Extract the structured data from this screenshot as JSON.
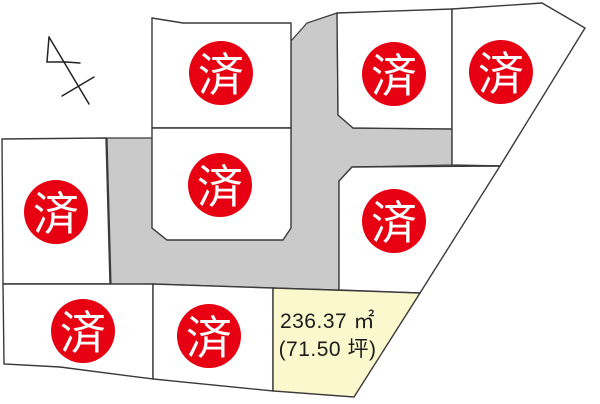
{
  "canvas": {
    "width": 600,
    "height": 404,
    "background": "#ffffff"
  },
  "palette": {
    "lot_fill": "#ffffff",
    "available_fill": "#fbf8cd",
    "road_fill": "#cacaca",
    "boundary": "#3a3a3a",
    "stamp_red": "#e60012",
    "stamp_text_color": "#ffffff",
    "label_text_color": "#1c1c1c"
  },
  "sold_stamp": {
    "label": "済",
    "radius": 32
  },
  "available_lot": {
    "area_m2": "236.37 ㎡",
    "area_tsubo": "(71.50 坪)"
  },
  "map": {
    "roads": [
      {
        "name": "access-road",
        "points": [
          [
            107,
            138
          ],
          [
            291,
            138
          ],
          [
            291,
            41
          ],
          [
            307,
            23
          ],
          [
            337,
            13
          ],
          [
            338,
            115
          ],
          [
            353,
            128
          ],
          [
            452,
            129
          ],
          [
            452,
            165
          ],
          [
            352,
            167
          ],
          [
            339,
            181
          ],
          [
            339,
            290
          ],
          [
            273,
            288
          ],
          [
            153,
            284
          ],
          [
            111,
            285
          ]
        ]
      }
    ],
    "lots": [
      {
        "name": "lot-top-center",
        "status": "sold",
        "points": [
          [
            152,
            18
          ],
          [
            183,
            23
          ],
          [
            291,
            23
          ],
          [
            291,
            128
          ],
          [
            152,
            128
          ]
        ],
        "stamp": [
          221,
          73
        ]
      },
      {
        "name": "lot-top-middle",
        "status": "sold",
        "points": [
          [
            337,
            13
          ],
          [
            452,
            9
          ],
          [
            452,
            129
          ],
          [
            353,
            128
          ],
          [
            338,
            115
          ]
        ],
        "stamp": [
          394,
          74
        ]
      },
      {
        "name": "lot-top-right",
        "status": "sold",
        "points": [
          [
            452,
            9
          ],
          [
            542,
            3
          ],
          [
            585,
            28
          ],
          [
            500,
            166
          ],
          [
            452,
            165
          ]
        ],
        "stamp": [
          501,
          72
        ]
      },
      {
        "name": "lot-left",
        "status": "sold",
        "points": [
          [
            2,
            139
          ],
          [
            106,
            138
          ],
          [
            110,
            284
          ],
          [
            3,
            284
          ]
        ],
        "stamp": [
          56,
          212
        ]
      },
      {
        "name": "lot-center",
        "status": "sold",
        "points": [
          [
            152,
            128
          ],
          [
            291,
            128
          ],
          [
            291,
            228
          ],
          [
            283,
            240
          ],
          [
            167,
            240
          ],
          [
            152,
            228
          ]
        ],
        "stamp": [
          220,
          185
        ]
      },
      {
        "name": "lot-right-middle",
        "status": "sold",
        "points": [
          [
            339,
            181
          ],
          [
            352,
            167
          ],
          [
            500,
            166
          ],
          [
            420,
            293
          ],
          [
            339,
            290
          ]
        ],
        "stamp": [
          394,
          221
        ]
      },
      {
        "name": "lot-bottom-left",
        "status": "sold",
        "points": [
          [
            3,
            284
          ],
          [
            153,
            284
          ],
          [
            153,
            379
          ],
          [
            60,
            367
          ],
          [
            4,
            364
          ]
        ],
        "stamp": [
          83,
          331
        ]
      },
      {
        "name": "lot-bottom-center",
        "status": "sold",
        "points": [
          [
            153,
            284
          ],
          [
            273,
            288
          ],
          [
            273,
            391
          ],
          [
            153,
            379
          ]
        ],
        "stamp": [
          209,
          336
        ]
      },
      {
        "name": "lot-available",
        "status": "available",
        "points": [
          [
            273,
            288
          ],
          [
            420,
            293
          ],
          [
            354,
            397
          ],
          [
            273,
            391
          ]
        ]
      }
    ],
    "north_arrow": {
      "lines": [
        [
          [
            49,
            37
          ],
          [
            89,
            104
          ]
        ],
        [
          [
            49,
            37
          ],
          [
            47,
            62
          ]
        ],
        [
          [
            47,
            62
          ],
          [
            66,
            62
          ]
        ],
        [
          [
            66,
            62
          ],
          [
            80,
            63
          ]
        ],
        [
          [
            62,
            96
          ],
          [
            94,
            77
          ]
        ]
      ]
    }
  }
}
